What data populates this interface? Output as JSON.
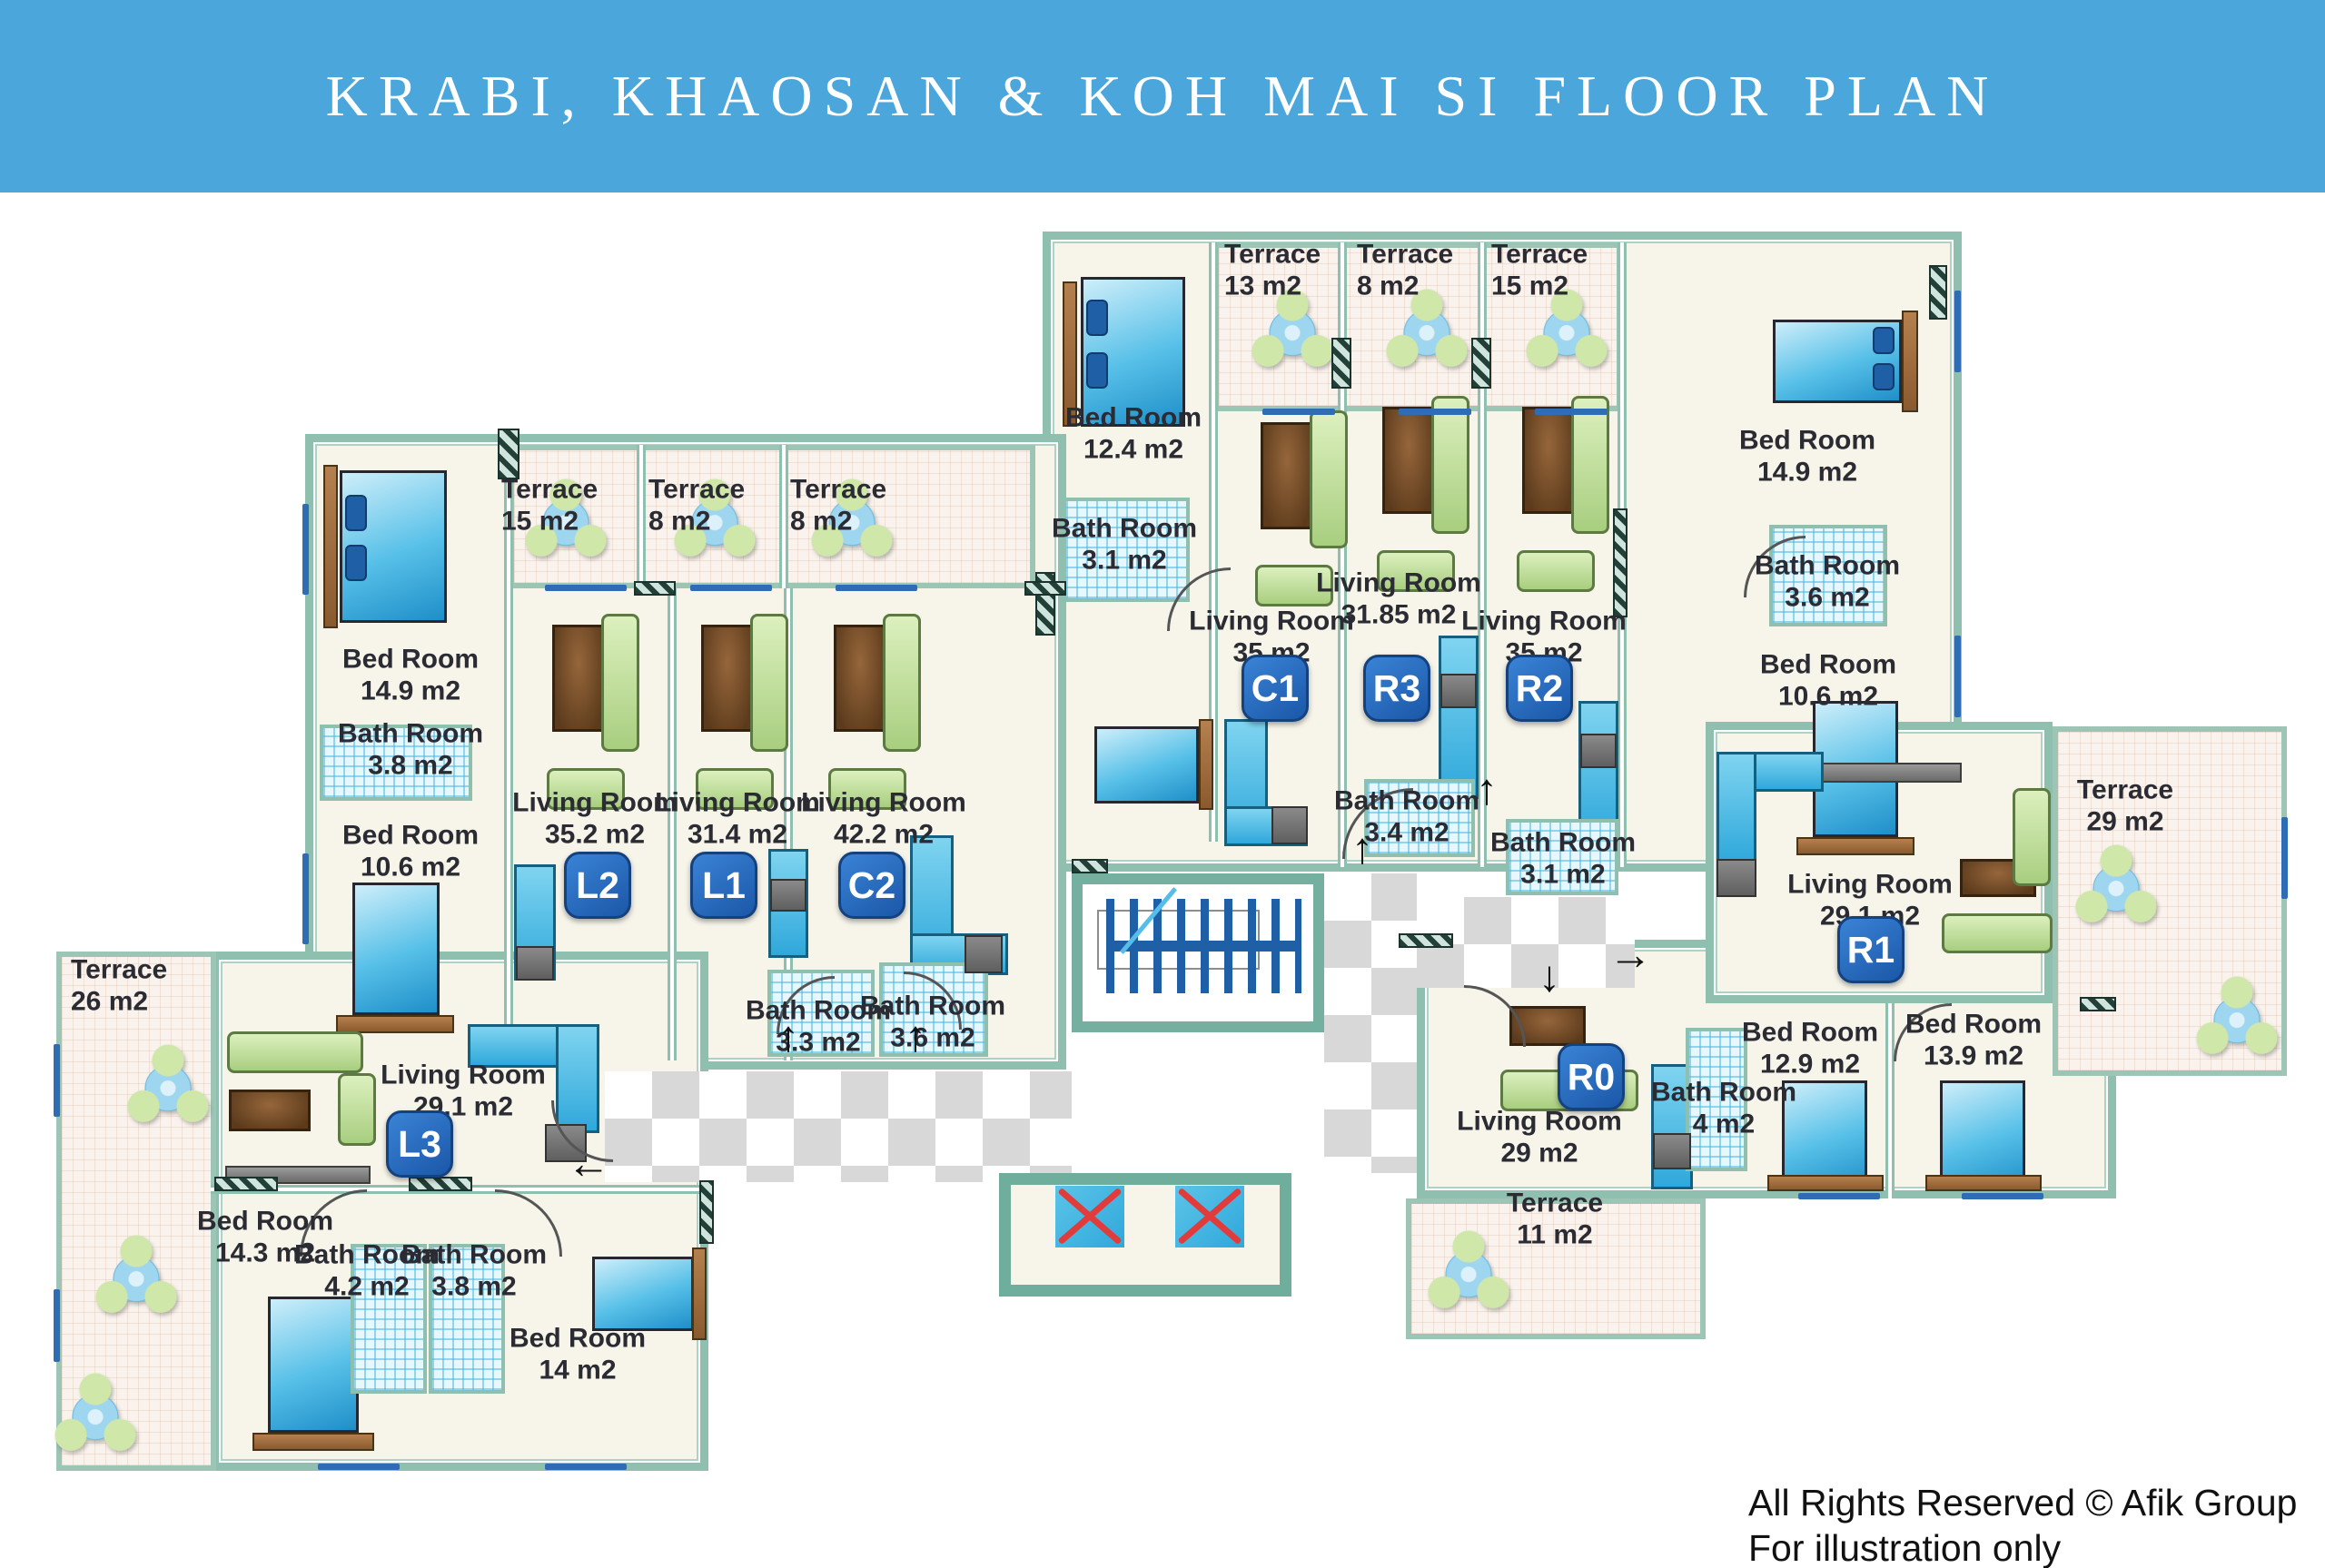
{
  "title": "KRABI, KHAOSAN & KOH MAI SI FLOOR PLAN",
  "footer": {
    "rights": "All Rights Reserved © Afik Group",
    "note": "For illustration only"
  },
  "icons": {
    "arrow_up": "↑",
    "arrow_down": "↓",
    "arrow_left": "←",
    "arrow_right": "→"
  },
  "colors": {
    "banner": "#4AA6DB",
    "wall": "#8FBFAF",
    "floor": "#F7F5EA",
    "terrace_floor": "#FAF3ED",
    "bath_tile": "#BDE6F5",
    "corridor_checker": "#D8D8D8",
    "unit_badge": "#1E5FB0",
    "bed": "#3FB0E0",
    "sofa": "#BCDF96",
    "table": "#7A4E28",
    "stairs": "#1E5FA6",
    "elevator": "#35AEDC",
    "elevator_x": "#E23B3B",
    "label_text": "#2B2B33"
  },
  "plan": {
    "top_building": {
      "left_wing": {
        "bedroom": {
          "name": "Bed Room",
          "area": "12.4 m2"
        },
        "bathroom": {
          "name": "Bath Room",
          "area": "3.1 m2"
        }
      },
      "unit_c1": {
        "badge": "C1",
        "terrace": {
          "name": "Terrace",
          "area": "13 m2"
        },
        "living": {
          "name": "Living Room",
          "area": "35 m2"
        }
      },
      "unit_r3": {
        "badge": "R3",
        "terrace": {
          "name": "Terrace",
          "area": "8 m2"
        },
        "living": {
          "name": "Living Room",
          "area": "31.85 m2"
        },
        "bathroom": {
          "name": "Bath Room",
          "area": "3.4 m2"
        }
      },
      "unit_r2": {
        "badge": "R2",
        "terrace": {
          "name": "Terrace",
          "area": "15 m2"
        },
        "living": {
          "name": "Living Room",
          "area": "35 m2"
        },
        "bathroom": {
          "name": "Bath Room",
          "area": "3.1 m2"
        }
      },
      "right_wing": {
        "bedroom_top": {
          "name": "Bed Room",
          "area": "14.9 m2"
        },
        "bathroom": {
          "name": "Bath Room",
          "area": "3.6 m2"
        },
        "bedroom_lower": {
          "name": "Bed Room",
          "area": "10.6 m2"
        }
      }
    },
    "left_building": {
      "left_wing": {
        "bedroom_top": {
          "name": "Bed Room",
          "area": "14.9 m2"
        },
        "bathroom": {
          "name": "Bath Room",
          "area": "3.8 m2"
        },
        "bedroom_lower": {
          "name": "Bed Room",
          "area": "10.6 m2"
        }
      },
      "unit_l2": {
        "badge": "L2",
        "terrace": {
          "name": "Terrace",
          "area": "15 m2"
        },
        "living": {
          "name": "Living Room",
          "area": "35.2 m2"
        }
      },
      "unit_l1": {
        "badge": "L1",
        "terrace": {
          "name": "Terrace",
          "area": "8 m2"
        },
        "living": {
          "name": "Living Room",
          "area": "31.4 m2"
        },
        "bathroom": {
          "name": "Bath Room",
          "area": "3.3 m2"
        }
      },
      "unit_c2": {
        "badge": "C2",
        "terrace": {
          "name": "Terrace",
          "area": "8 m2"
        },
        "living": {
          "name": "Living Room",
          "area": "42.2 m2"
        },
        "bathroom": {
          "name": "Bath Room",
          "area": "3.6 m2"
        }
      }
    },
    "unit_l3": {
      "badge": "L3",
      "terrace": {
        "name": "Terrace",
        "area": "26 m2"
      },
      "living": {
        "name": "Living Room",
        "area": "29.1 m2"
      },
      "bedroom_a": {
        "name": "Bed Room",
        "area": "14.3 m2"
      },
      "bathroom_a": {
        "name": "Bath Room",
        "area": "4.2 m2"
      },
      "bathroom_b": {
        "name": "Bath Room",
        "area": "3.8 m2"
      },
      "bedroom_b": {
        "name": "Bed Room",
        "area": "14 m2"
      }
    },
    "unit_r1": {
      "badge": "R1",
      "terrace": {
        "name": "Terrace",
        "area": "29 m2"
      },
      "living": {
        "name": "Living Room",
        "area": "29.1 m2"
      }
    },
    "unit_r0": {
      "badge": "R0",
      "terrace": {
        "name": "Terrace",
        "area": "11 m2"
      },
      "living": {
        "name": "Living Room",
        "area": "29 m2"
      },
      "bathroom": {
        "name": "Bath Room",
        "area": "4 m2"
      },
      "bedroom_a": {
        "name": "Bed Room",
        "area": "12.9 m2"
      },
      "bedroom_b": {
        "name": "Bed Room",
        "area": "13.9 m2"
      }
    }
  }
}
